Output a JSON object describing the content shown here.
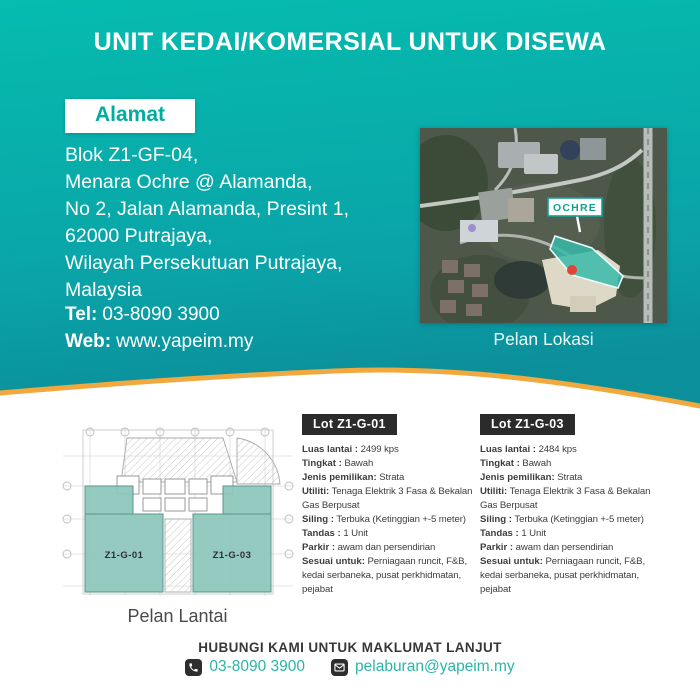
{
  "page_title": "UNIT KEDAI/KOMERSIAL UNTUK DISEWA",
  "colors": {
    "teal_top": "#05bcae",
    "teal_bottom": "#0b96a0",
    "wave_orange": "#f1a83e",
    "accent_teal": "#00ada3",
    "dark_tag": "#2b2b2b",
    "plan_unit_fill": "#8cc5bc",
    "map_site_fill": "#38b9a9"
  },
  "address": {
    "label": "Alamat",
    "lines": [
      "Blok Z1-GF-04,",
      "Menara Ochre @ Alamanda,",
      "No 2, Jalan Alamanda, Presint 1,",
      "62000 Putrajaya,",
      "Wilayah Persekutuan Putrajaya,",
      "Malaysia"
    ],
    "tel_label": "Tel:",
    "tel_value": "03-8090 3900",
    "web_label": "Web:",
    "web_value": "www.yapeim.my"
  },
  "map": {
    "caption": "Pelan Lokasi",
    "marker_label": "OCHRE"
  },
  "floorplan": {
    "caption": "Pelan Lantai",
    "unit1_label": "Z1-G-01",
    "unit2_label": "Z1-G-03"
  },
  "lots": [
    {
      "name": "Lot Z1-G-01",
      "fields": [
        {
          "label": "Luas lantai :",
          "value": "2499 kps"
        },
        {
          "label": "Tingkat :",
          "value": "Bawah"
        },
        {
          "label": "Jenis pemilikan:",
          "value": "Strata"
        },
        {
          "label": "Utiliti:",
          "value": "Tenaga Elektrik 3 Fasa & Bekalan Gas Berpusat"
        },
        {
          "label": "Siling :",
          "value": "Terbuka (Ketinggian +-5 meter)"
        },
        {
          "label": "Tandas :",
          "value": "1 Unit"
        },
        {
          "label": "Parkir :",
          "value": "awam dan persendirian"
        },
        {
          "label": "Sesuai untuk:",
          "value": "Perniagaan runcit, F&B, kedai serbaneka, pusat perkhidmatan, pejabat"
        }
      ]
    },
    {
      "name": "Lot Z1-G-03",
      "fields": [
        {
          "label": "Luas lantai :",
          "value": "2484 kps"
        },
        {
          "label": "Tingkat :",
          "value": "Bawah"
        },
        {
          "label": "Jenis pemilikan:",
          "value": "Strata"
        },
        {
          "label": "Utiliti:",
          "value": "Tenaga Elektrik 3 Fasa & Bekalan Gas Berpusat"
        },
        {
          "label": "Siling :",
          "value": "Terbuka (Ketinggian +-5 meter)"
        },
        {
          "label": "Tandas :",
          "value": "1 Unit"
        },
        {
          "label": "Parkir :",
          "value": "awam dan persendirian"
        },
        {
          "label": "Sesuai untuk:",
          "value": "Perniagaan runcit, F&B, kedai serbaneka, pusat perkhidmatan, pejabat"
        }
      ]
    }
  ],
  "footer": {
    "heading": "HUBUNGI KAMI UNTUK MAKLUMAT LANJUT",
    "phone": "03-8090 3900",
    "email": "pelaburan@yapeim.my"
  }
}
